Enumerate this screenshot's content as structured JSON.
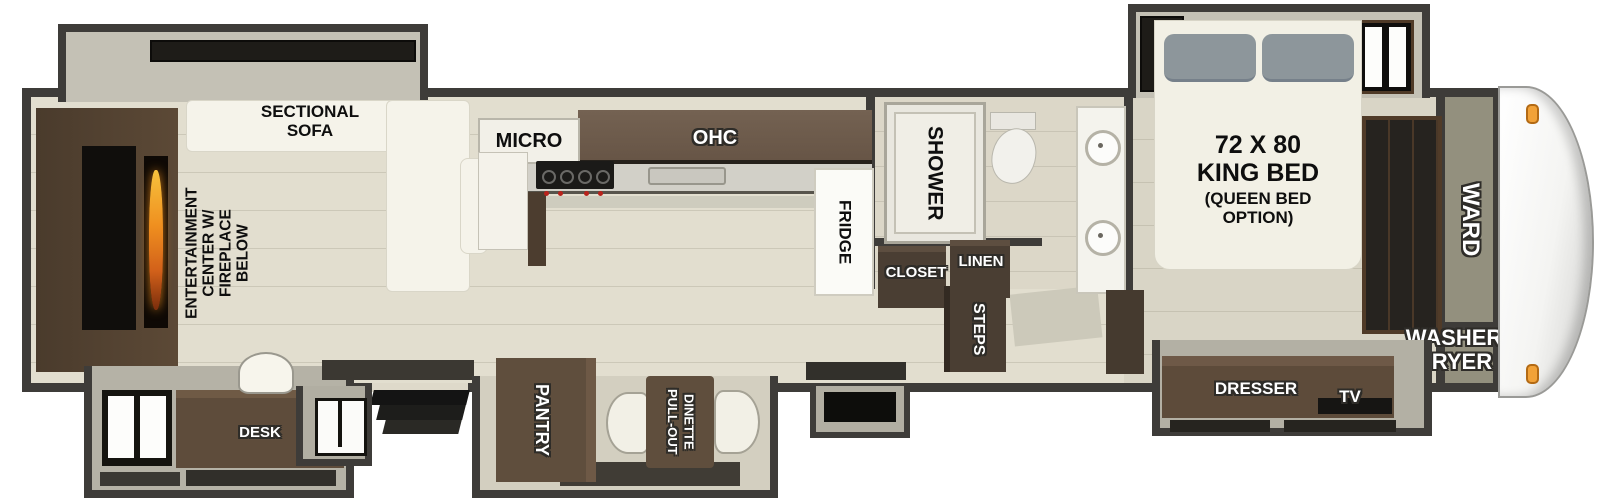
{
  "floorplan": {
    "living_area": {
      "entertainment_label": "ENTERTAINMENT\nCENTER W/\nFIREPLACE BELOW",
      "sofa_label": "SECTIONAL\nSOFA",
      "desk_label": "DESK"
    },
    "kitchen": {
      "micro_label": "MICRO",
      "ohc_label": "OHC",
      "fridge_label": "FRIDGE",
      "pantry_label": "PANTRY",
      "dinette_line1": "PULL-OUT",
      "dinette_line2": "DINETTE"
    },
    "bathroom": {
      "shower_label": "SHOWER",
      "closet_label": "CLOSET",
      "linen_label": "LINEN"
    },
    "hallway": {
      "steps_label": "STEPS"
    },
    "bedroom": {
      "bed_size": "72 X 80",
      "bed_type": "KING BED",
      "bed_option": "(QUEEN BED\nOPTION)",
      "dresser_label": "DRESSER",
      "tv_label": "TV",
      "ward_label": "WARD",
      "washer_dryer_label": "WASHER\nDRYER"
    },
    "colors": {
      "wall": "#3e3c39",
      "floor": "#e2decf",
      "cabinet_brown": "#5f4e3d",
      "cabinet_dark_brown": "#4a3e33",
      "furniture_white": "#f5f3ea",
      "slide_wall_gray": "#b5b2a6",
      "flame_orange": "#ef8f1f",
      "marker_light_orange": "#f2a238",
      "label_black": "#0e0e0e",
      "label_white": "#ffffff"
    }
  }
}
